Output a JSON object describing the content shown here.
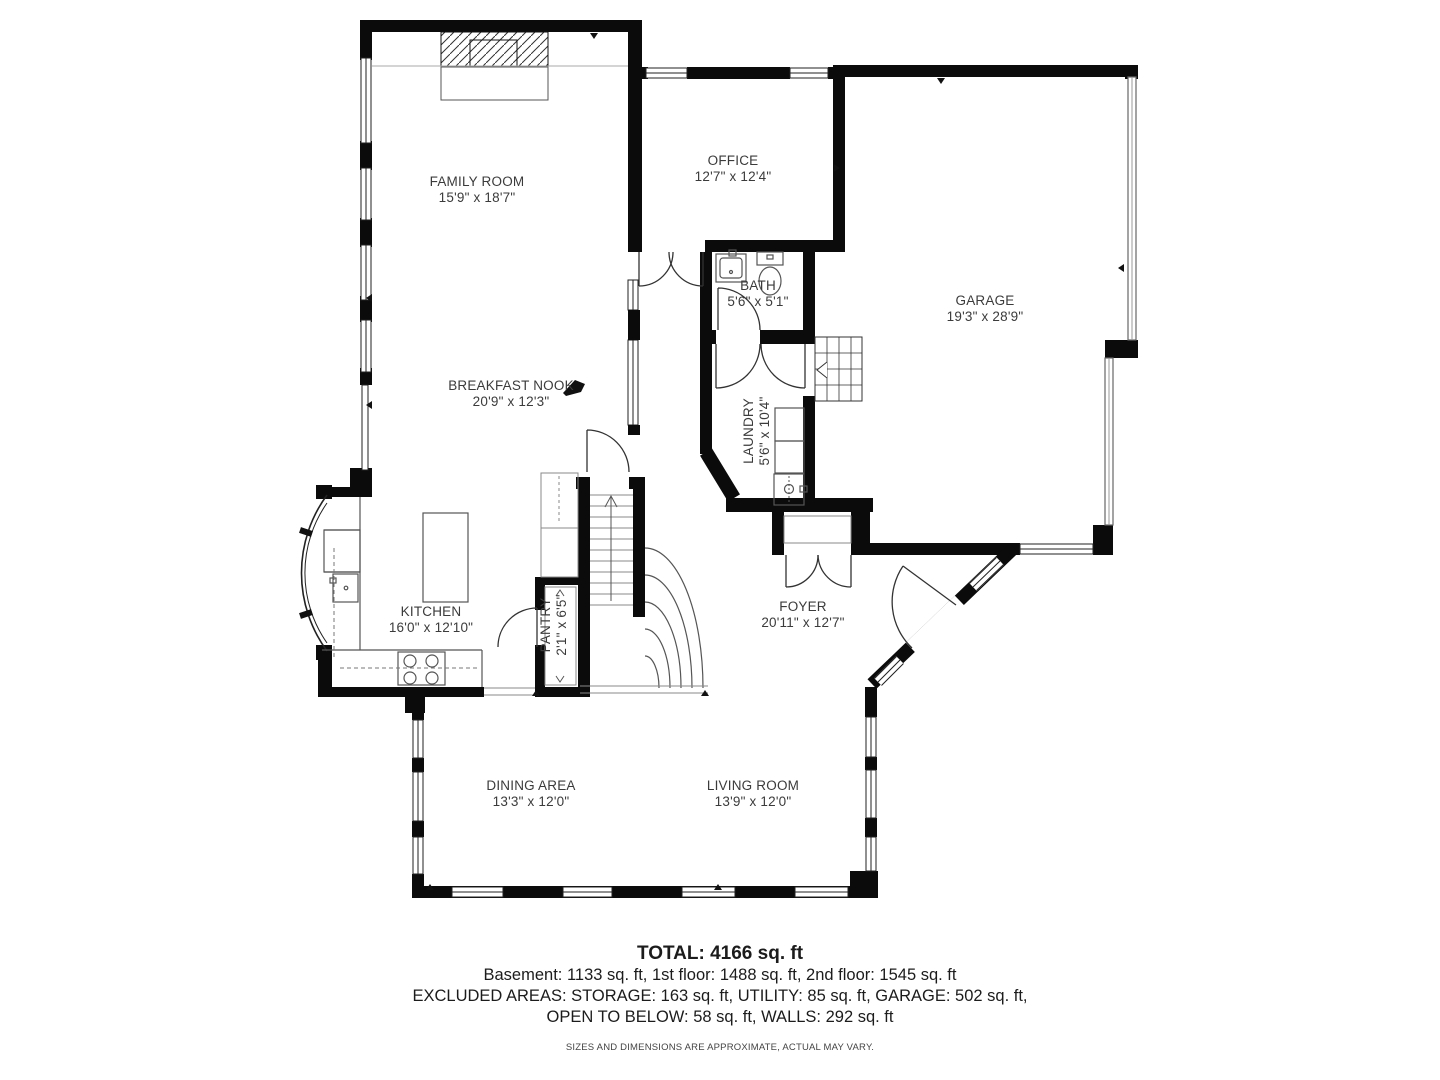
{
  "title": "First floor plan",
  "rooms": [
    {
      "name": "FAMILY ROOM",
      "dims": "15'9\" x 18'7\""
    },
    {
      "name": "OFFICE",
      "dims": "12'7\" x 12'4\""
    },
    {
      "name": "BATH",
      "dims": "5'6\" x 5'1\""
    },
    {
      "name": "GARAGE",
      "dims": "19'3\" x 28'9\""
    },
    {
      "name": "BREAKFAST NOOK",
      "dims": "20'9\" x 12'3\""
    },
    {
      "name": "LAUNDRY",
      "dims": "5'6\" x 10'4\""
    },
    {
      "name": "KITCHEN",
      "dims": "16'0\" x 12'10\""
    },
    {
      "name": "PANTRY",
      "dims": "2'1\" x 6'5\""
    },
    {
      "name": "FOYER",
      "dims": "20'11\" x 12'7\""
    },
    {
      "name": "DINING AREA",
      "dims": "13'3\" x 12'0\""
    },
    {
      "name": "LIVING ROOM",
      "dims": "13'9\" x 12'0\""
    }
  ],
  "summary": {
    "total": "TOTAL: 4166 sq. ft",
    "line1": "Basement: 1133 sq. ft, 1st floor: 1488 sq. ft, 2nd floor: 1545 sq. ft",
    "line2": "EXCLUDED AREAS: STORAGE: 163 sq. ft, UTILITY: 85 sq. ft, GARAGE: 502 sq. ft,",
    "line3": "OPEN TO BELOW: 58 sq. ft, WALLS: 292 sq. ft",
    "disclaimer": "SIZES AND DIMENSIONS ARE APPROXIMATE, ACTUAL MAY VARY."
  },
  "colors": {
    "wall": "#0b0b0b",
    "label": "#3b3b3b",
    "fixture": "#555555"
  }
}
